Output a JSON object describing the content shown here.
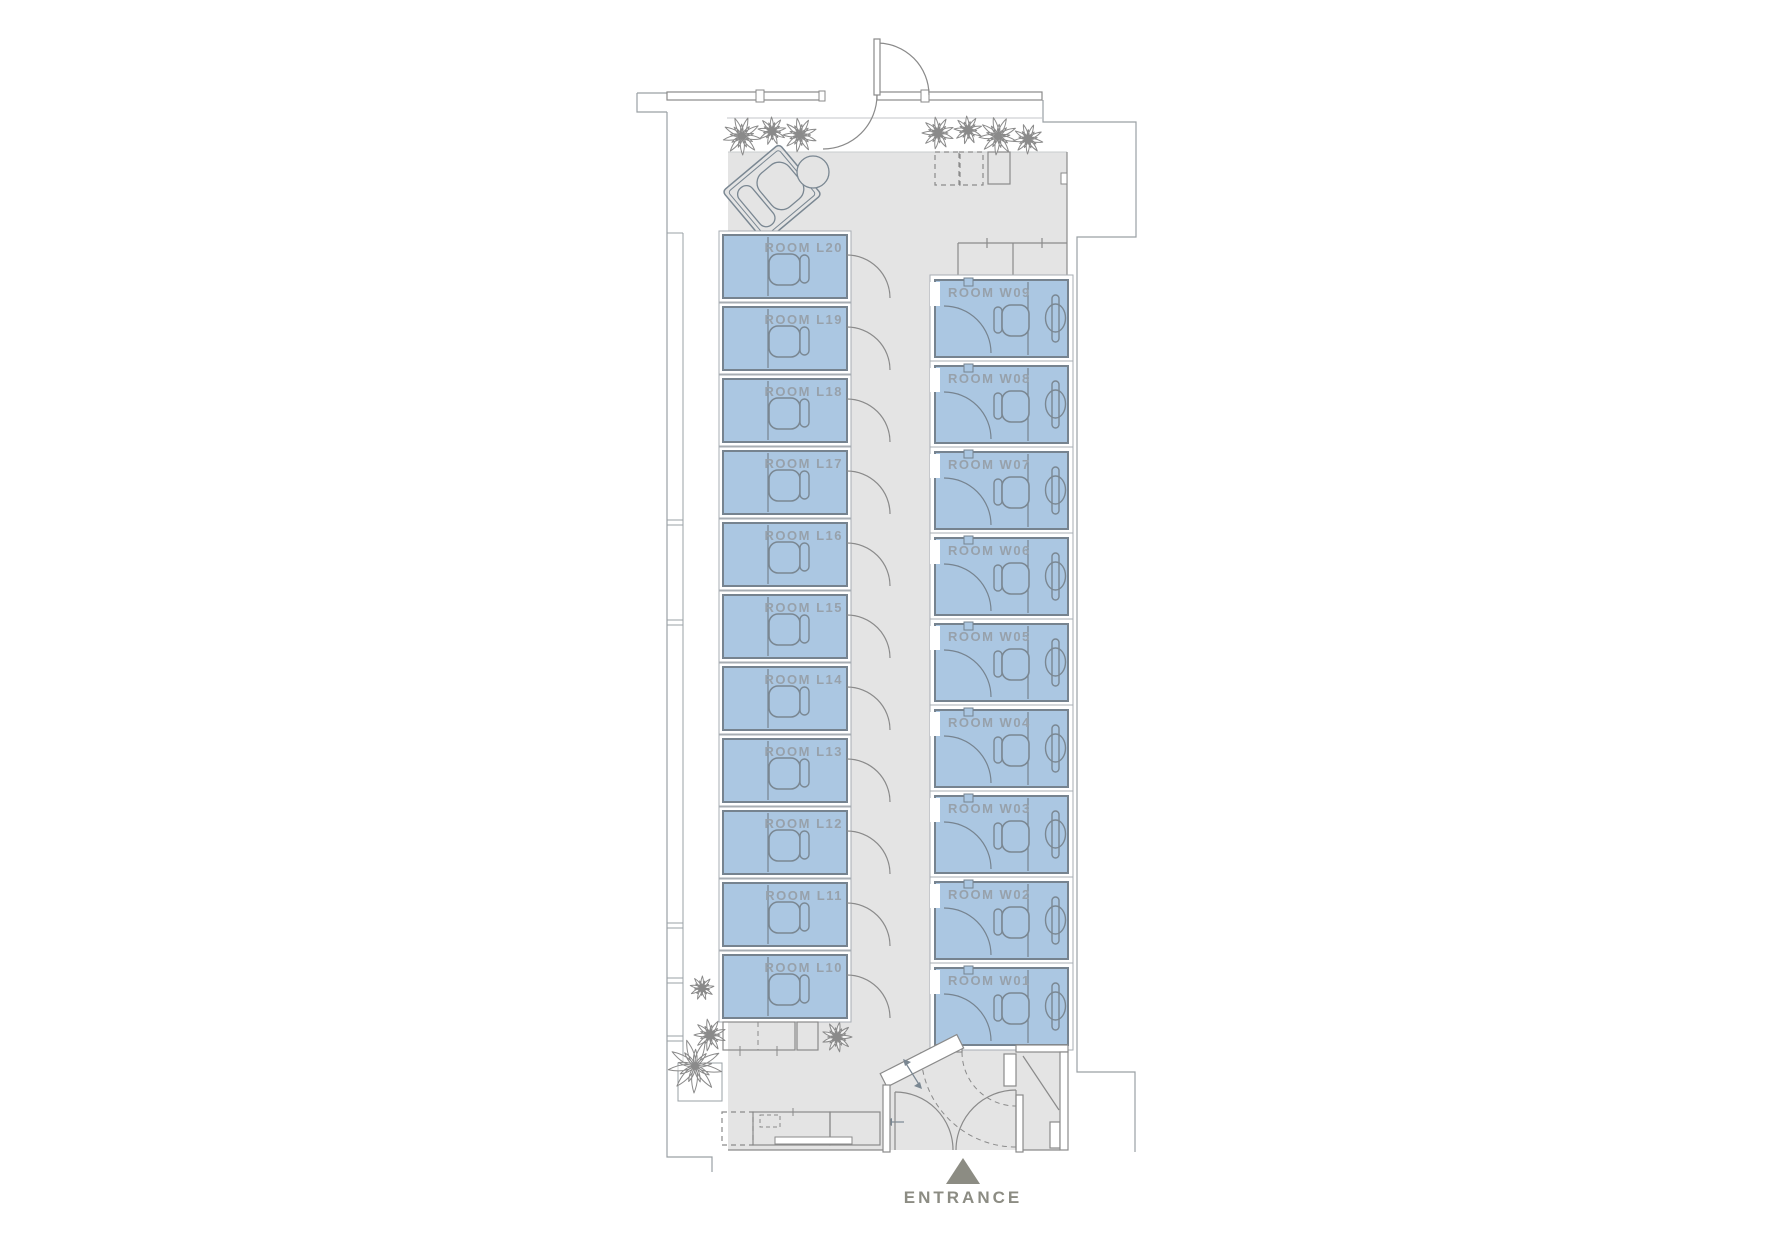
{
  "plan": {
    "entrance": {
      "label": "ENTRANCE",
      "marker": "up-triangle"
    },
    "left_rooms": [
      "ROOM L20",
      "ROOM L19",
      "ROOM L18",
      "ROOM L17",
      "ROOM L16",
      "ROOM L15",
      "ROOM L14",
      "ROOM L13",
      "ROOM L12",
      "ROOM L11",
      "ROOM L10"
    ],
    "right_rooms": [
      "ROOM W09",
      "ROOM W08",
      "ROOM W07",
      "ROOM W06",
      "ROOM W05",
      "ROOM W04",
      "ROOM W03",
      "ROOM W02",
      "ROOM W01"
    ],
    "colors": {
      "floor": "#e4e4e4",
      "room_fill": "#abc7e2",
      "room_border": "#76838f",
      "room_surround": "#a7adb3",
      "wall": "#8a8a8a",
      "thin_outline": "#9aa0a5",
      "label": "#97a1ab",
      "furniture": "#7a8792",
      "plant": "#8a8a8a",
      "entrance": "#8c8c83"
    },
    "icons": [
      "plant-icon",
      "lounge-chair-icon",
      "side-table-icon",
      "door-swing-icon",
      "office-chair-icon",
      "desk-fixture-icon",
      "entrance-arrow-icon",
      "counter-icon",
      "storage-box-icon"
    ]
  }
}
